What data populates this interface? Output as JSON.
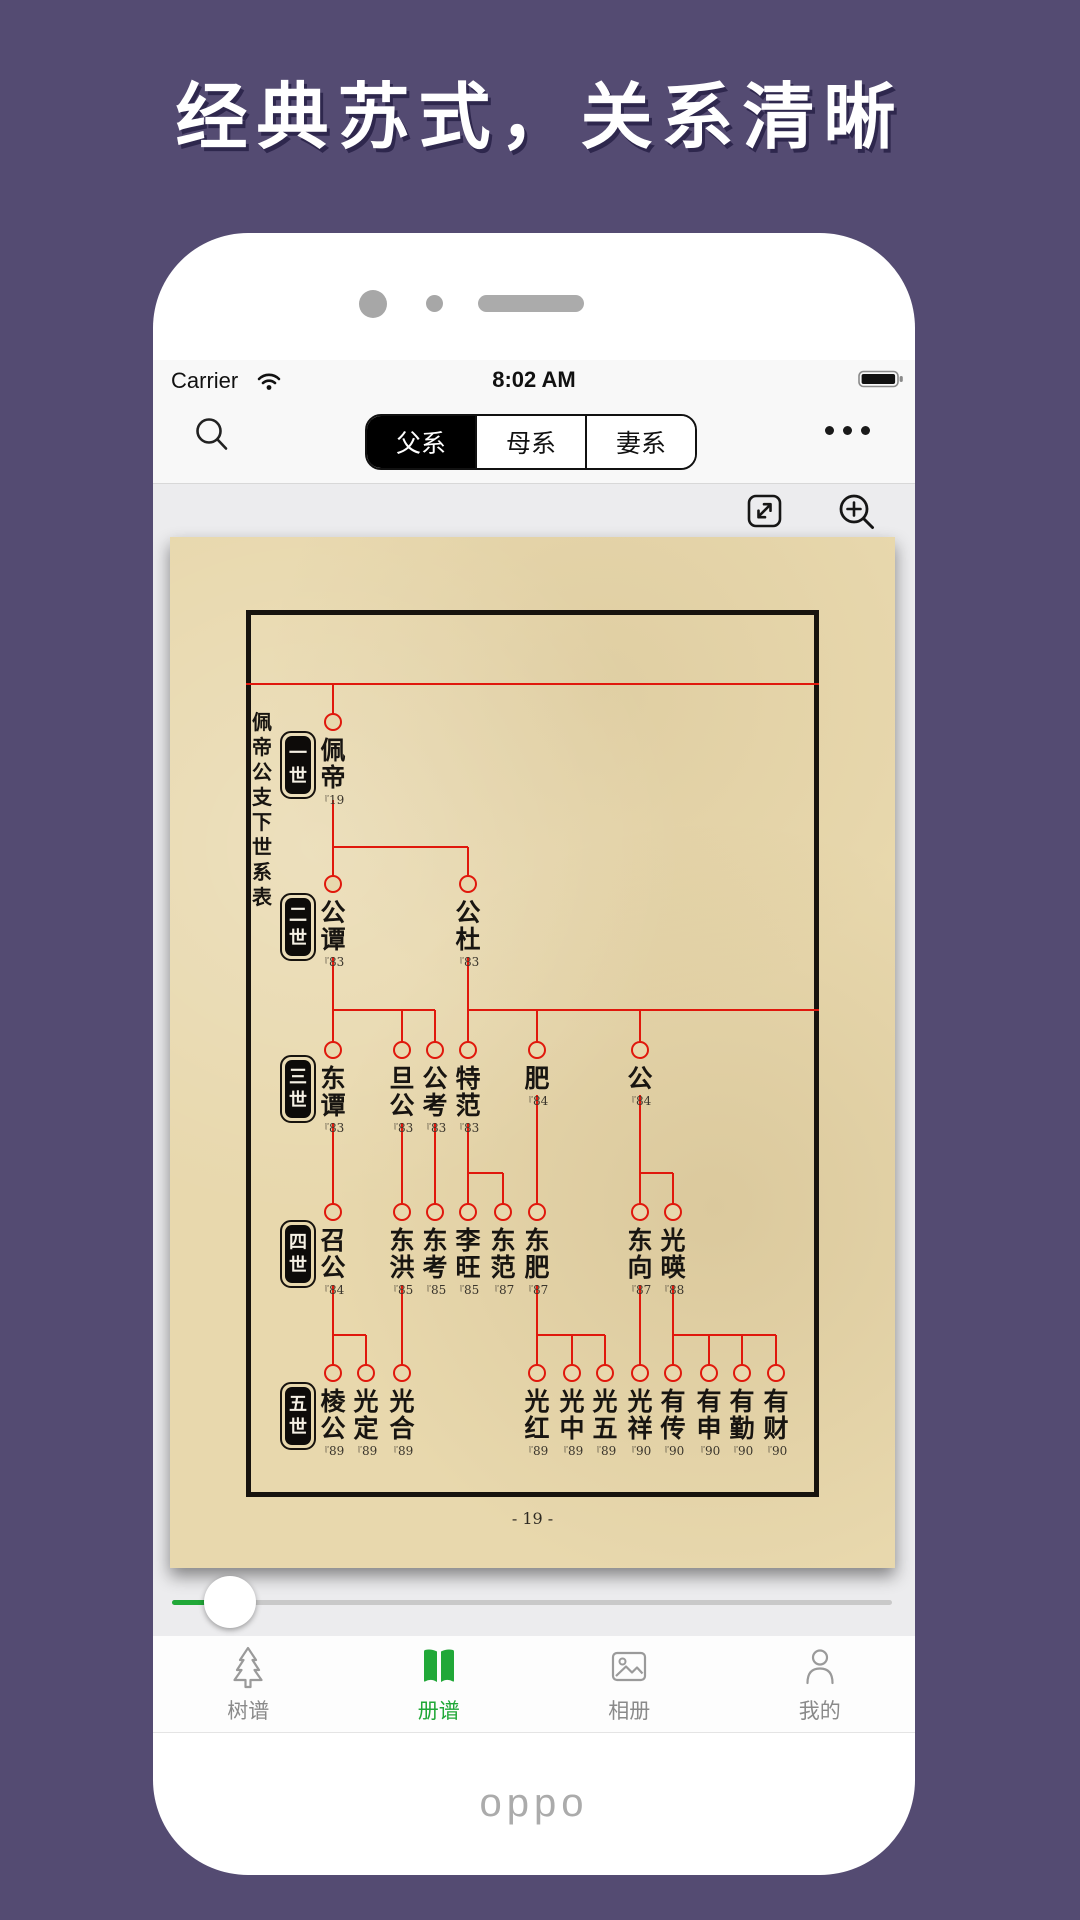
{
  "hero_title": "经典苏式，关系清晰",
  "statusbar": {
    "carrier": "Carrier",
    "time": "8:02 AM",
    "icons": [
      "wifi-icon",
      "battery-icon"
    ]
  },
  "nav": {
    "segments": [
      {
        "label": "父系",
        "selected": true
      },
      {
        "label": "母系",
        "selected": false
      },
      {
        "label": "妻系",
        "selected": false
      }
    ],
    "icons": [
      "search-icon",
      "more-icon"
    ]
  },
  "toolbar": {
    "icons": [
      "expand-icon",
      "zoom-in-icon"
    ]
  },
  "tree": {
    "side_title": "佩帝公支下世系表",
    "page_number": "- 19 -",
    "ref_mark": "『",
    "generation_labels": [
      "一世",
      "二世",
      "三世",
      "四世",
      "五世"
    ],
    "layout": {
      "row_y": [
        185,
        347,
        513,
        675,
        836
      ],
      "badge_x": 128,
      "badge_y": [
        228,
        390,
        552,
        717,
        879
      ],
      "side_title_pos": [
        82,
        173
      ],
      "page_number_y": 972
    },
    "nodes": [
      {
        "gen": 1,
        "x": 163,
        "name": "佩帝",
        "ref": "19"
      },
      {
        "gen": 2,
        "x": 163,
        "name": "公谭",
        "ref": "83"
      },
      {
        "gen": 2,
        "x": 298,
        "name": "公杜",
        "ref": "83"
      },
      {
        "gen": 3,
        "x": 163,
        "name": "东谭",
        "ref": "83"
      },
      {
        "gen": 3,
        "x": 232,
        "name": "旦公",
        "ref": "83"
      },
      {
        "gen": 3,
        "x": 265,
        "name": "公考",
        "ref": "83"
      },
      {
        "gen": 3,
        "x": 298,
        "name": "特范",
        "ref": "83"
      },
      {
        "gen": 3,
        "x": 367,
        "name": "肥",
        "ref": "84"
      },
      {
        "gen": 3,
        "x": 470,
        "name": "公",
        "ref": "84"
      },
      {
        "gen": 4,
        "x": 163,
        "name": "召公",
        "ref": "84"
      },
      {
        "gen": 4,
        "x": 232,
        "name": "东洪",
        "ref": "85"
      },
      {
        "gen": 4,
        "x": 265,
        "name": "东考",
        "ref": "85"
      },
      {
        "gen": 4,
        "x": 298,
        "name": "李旺",
        "ref": "85"
      },
      {
        "gen": 4,
        "x": 333,
        "name": "东范",
        "ref": "87"
      },
      {
        "gen": 4,
        "x": 367,
        "name": "东肥",
        "ref": "87"
      },
      {
        "gen": 4,
        "x": 470,
        "name": "东向",
        "ref": "87"
      },
      {
        "gen": 4,
        "x": 503,
        "name": "光暎",
        "ref": "88"
      },
      {
        "gen": 5,
        "x": 163,
        "name": "棱公",
        "ref": "89"
      },
      {
        "gen": 5,
        "x": 196,
        "name": "光定",
        "ref": "89"
      },
      {
        "gen": 5,
        "x": 232,
        "name": "光合",
        "ref": "89"
      },
      {
        "gen": 5,
        "x": 367,
        "name": "光红",
        "ref": "89"
      },
      {
        "gen": 5,
        "x": 402,
        "name": "光中",
        "ref": "89"
      },
      {
        "gen": 5,
        "x": 435,
        "name": "光五",
        "ref": "89"
      },
      {
        "gen": 5,
        "x": 470,
        "name": "光祥",
        "ref": "90"
      },
      {
        "gen": 5,
        "x": 503,
        "name": "有传",
        "ref": "90"
      },
      {
        "gen": 5,
        "x": 539,
        "name": "有申",
        "ref": "90"
      },
      {
        "gen": 5,
        "x": 572,
        "name": "有勤",
        "ref": "90"
      },
      {
        "gen": 5,
        "x": 606,
        "name": "有财",
        "ref": "90"
      }
    ],
    "connectors": [
      [
        76,
        147,
        649,
        147
      ],
      [
        163,
        310,
        298,
        310
      ],
      [
        163,
        473,
        265,
        473
      ],
      [
        298,
        473,
        649,
        473
      ],
      [
        298,
        636,
        333,
        636
      ],
      [
        470,
        636,
        503,
        636
      ],
      [
        163,
        798,
        196,
        798
      ],
      [
        367,
        798,
        435,
        798
      ],
      [
        503,
        798,
        606,
        798
      ],
      [
        163,
        147,
        163,
        185
      ],
      [
        163,
        263,
        163,
        347
      ],
      [
        298,
        310,
        298,
        347
      ],
      [
        163,
        420,
        163,
        513
      ],
      [
        232,
        473,
        232,
        513
      ],
      [
        265,
        473,
        265,
        513
      ],
      [
        298,
        420,
        298,
        513
      ],
      [
        367,
        473,
        367,
        513
      ],
      [
        470,
        473,
        470,
        513
      ],
      [
        163,
        586,
        163,
        675
      ],
      [
        232,
        586,
        232,
        675
      ],
      [
        265,
        586,
        265,
        675
      ],
      [
        298,
        586,
        298,
        675
      ],
      [
        333,
        636,
        333,
        675
      ],
      [
        367,
        558,
        367,
        675
      ],
      [
        470,
        558,
        470,
        675
      ],
      [
        503,
        636,
        503,
        675
      ],
      [
        163,
        748,
        163,
        836
      ],
      [
        196,
        798,
        196,
        836
      ],
      [
        232,
        748,
        232,
        836
      ],
      [
        367,
        748,
        367,
        836
      ],
      [
        402,
        798,
        402,
        836
      ],
      [
        435,
        798,
        435,
        836
      ],
      [
        470,
        748,
        470,
        836
      ],
      [
        503,
        748,
        503,
        836
      ],
      [
        539,
        798,
        539,
        836
      ],
      [
        572,
        798,
        572,
        836
      ],
      [
        606,
        798,
        606,
        836
      ]
    ]
  },
  "slider": {
    "value_percent": 8
  },
  "tabbar": {
    "items": [
      {
        "label": "树谱",
        "icon": "tree-icon",
        "active": false
      },
      {
        "label": "册谱",
        "icon": "book-icon",
        "active": true
      },
      {
        "label": "相册",
        "icon": "album-icon",
        "active": false
      },
      {
        "label": "我的",
        "icon": "user-icon",
        "active": false
      }
    ]
  },
  "brand": "oppo",
  "colors": {
    "background_purple": "#544b72",
    "accent_green": "#21a838",
    "tree_line_red": "#e0180c",
    "parchment": "#e8d8ad"
  }
}
